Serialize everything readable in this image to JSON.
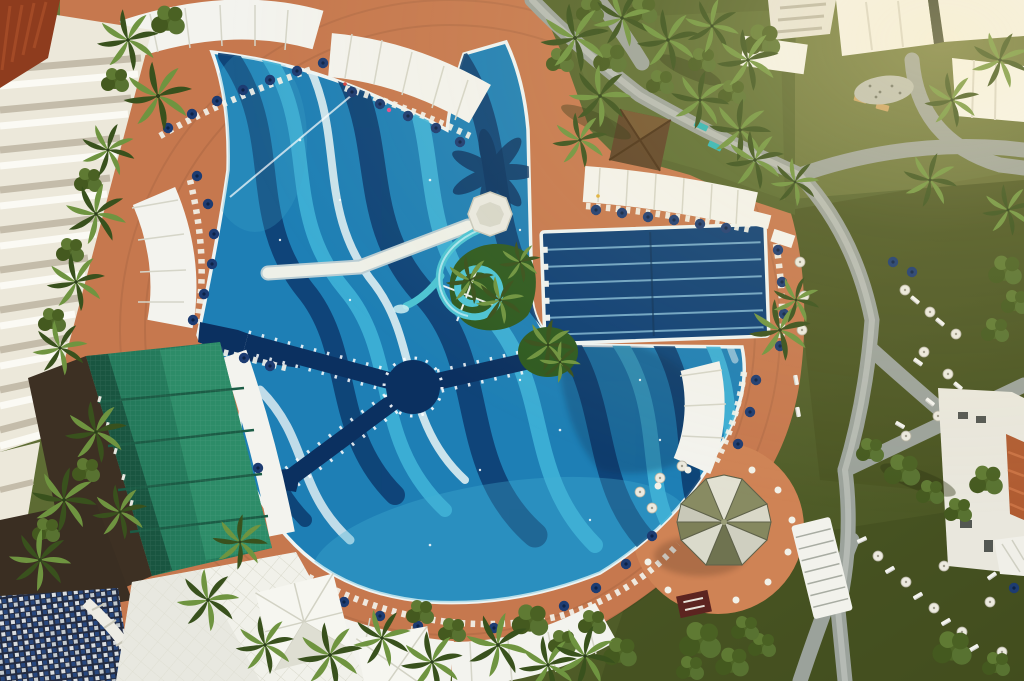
{
  "meta": {
    "title": "Aerial top-down photograph of a resort swimming-pool complex",
    "type": "aerial-photograph",
    "visible_text": "none"
  },
  "palette": {
    "grass_base": "#5d6a31",
    "grass_dark": "#47511f",
    "grass_warm": "#8d9350",
    "path_gray": "#9ba29b",
    "path_light": "#bcc1ba",
    "deck": "#bf7048",
    "deck_light": "#d38d5e",
    "pool_base": "#1e7fb5",
    "wave_navy": "#0e4074",
    "wave_aqua": "#3fb3d8",
    "wave_white": "#e9f4f6",
    "pool_deep": "#0b3060",
    "lane_line": "#7fb6d4",
    "rim_white": "#eef4f3",
    "slide_teal": "#4cc4d4",
    "umbrella_navy": "#1d3c72",
    "canopy_white": "#f3f3ee",
    "green_roof": "#247a5b",
    "green_roof_dark": "#174f3c",
    "palm_green": "#6f9440",
    "palm_dark": "#39511d",
    "bush_green": "#4e6526",
    "hotel_white": "#ece8da",
    "roof_red": "#8e3c1e",
    "building_white": "#f4f3ec",
    "roof_orange": "#b05c32",
    "mosaic_navy": "#27477e",
    "mosaic_light": "#d9dde0",
    "gazebo_olive": "#85885f",
    "terrace": "#c87d52"
  },
  "scene": {
    "description": "Bird's-eye drone view of a hotel pool area at golden hour",
    "main_pool": {
      "label": "free-form leisure pool",
      "mosaic": "wavy stripes in navy, aqua and white over mid-blue tile",
      "features": [
        "palm-shaped dark mosaic near top edge",
        "central round deep-water island with three dark walkway bridges",
        "spiral water slide with white start platform and access walkway",
        "planted palm islands inside the pool"
      ]
    },
    "lap_pool": {
      "label": "rectangular lap pool",
      "lanes": 6
    },
    "water_slide": {
      "label": "spiral slide",
      "turns": 2
    },
    "deck": {
      "label": "terracotta pool deck",
      "furniture": "sun loungers with navy parasols"
    },
    "canopies": {
      "label": "white shade canopies",
      "arrangement": "radial bands around the pool"
    },
    "gazebo": {
      "label": "octagonal gazebo parasol on round terrace",
      "segments": 8
    },
    "green_roof_building": {
      "label": "green mesh-roof pavilion (amphitheatre/bar)"
    },
    "hotel": {
      "label": "white hotel wing with stepped balconies",
      "corner_roof": "red-brown"
    },
    "grounds": {
      "label": "lawns with grey walking paths",
      "right_side": "grass with white parasols and loungers",
      "top_right": "white flat-roof villas",
      "bottom_left": "white event tents and blue-white tiled terrace"
    },
    "approx_counts": {
      "navy_parasols": 58,
      "white_parasols": 24,
      "white_canopy_bands": 9,
      "palm_trees": 40
    }
  }
}
